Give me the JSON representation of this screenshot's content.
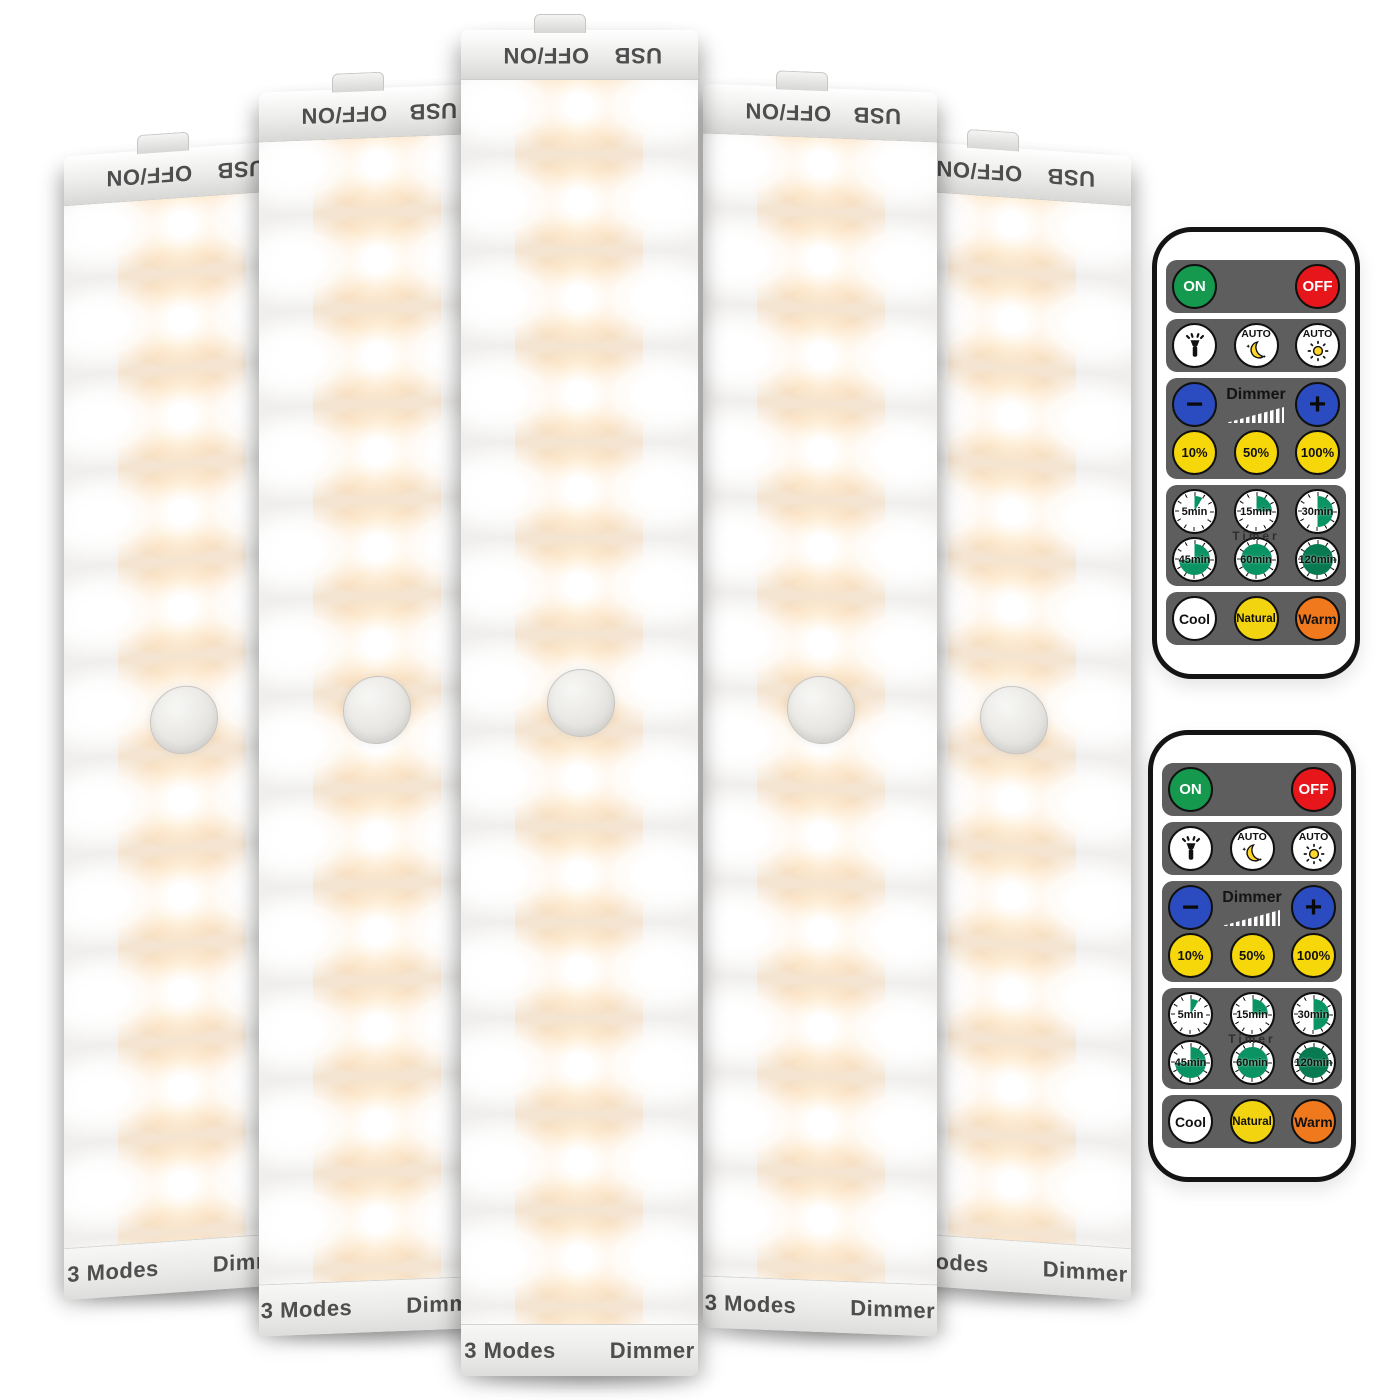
{
  "light_bar": {
    "count": 5,
    "top_cap": {
      "left_label": "OFF/ON",
      "right_label": "USB"
    },
    "bottom_cap": {
      "left_label": "3 Modes",
      "right_label": "Dimmer"
    },
    "led_columns": [
      "white",
      "warm-white",
      "white"
    ],
    "led_rows": 13,
    "parts": [
      "slide-switch-tab",
      "motion-sensor-dome"
    ],
    "colors": {
      "body": "#f2f1ef",
      "warm_glow": "#ffcb8c",
      "cap_text": "#4e4e4e"
    }
  },
  "remote_control": {
    "count": 2,
    "body_color": "#ffffff",
    "button_group_color": "#5e5e5e",
    "power_row": [
      {
        "label": "ON",
        "color": "#14994e"
      },
      {
        "label": "OFF",
        "color": "#e7161b"
      }
    ],
    "mode_row": [
      {
        "icon": "flashlight-icon"
      },
      {
        "label": "AUTO",
        "icon": "moon-stars-icon"
      },
      {
        "label": "AUTO",
        "icon": "sun-icon"
      }
    ],
    "dimmer_row": {
      "minus_label": "−",
      "plus_label": "+",
      "label": "Dimmer",
      "icon": "ramp-icon",
      "button_color": "#2a4cc0"
    },
    "brightness_row": [
      {
        "label": "10%"
      },
      {
        "label": "50%"
      },
      {
        "label": "100%"
      }
    ],
    "brightness_button_color": "#f6d70a",
    "timer_group": {
      "label": "Timer",
      "fill_color": "#0b9463",
      "buttons": [
        {
          "label": "5min",
          "fill_deg": 30
        },
        {
          "label": "15min",
          "fill_deg": 90
        },
        {
          "label": "30min",
          "fill_deg": 180
        },
        {
          "label": "45min",
          "fill_deg": 270
        },
        {
          "label": "60min",
          "fill_deg": 360
        },
        {
          "label": "120min",
          "fill_deg": 360,
          "fill_color": "#077a52"
        }
      ]
    },
    "color_temp_row": [
      {
        "label": "Cool",
        "color": "#ffffff"
      },
      {
        "label": "Natural",
        "color": "#f2d410"
      },
      {
        "label": "Warm",
        "color": "#f0791e"
      }
    ]
  }
}
